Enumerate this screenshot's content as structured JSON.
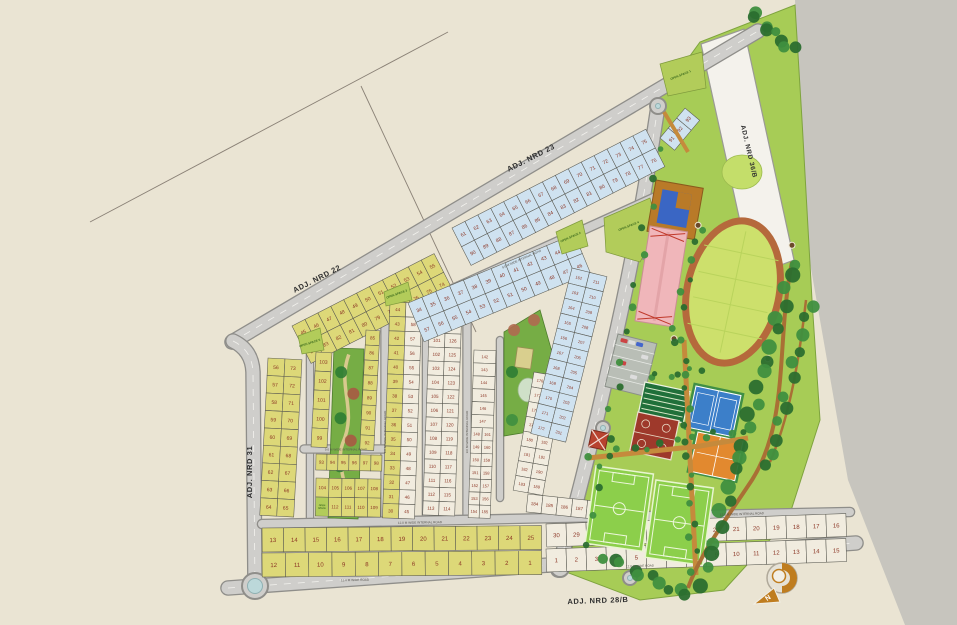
{
  "photo": {
    "width": 957,
    "height": 625,
    "bg": "#eae4d3",
    "bg_edge": "#c7c5be",
    "gray_region": "795,0 957,0 957,625 905,625 848,480 806,240",
    "boundary_lines": [
      [
        90,
        222,
        448,
        32
      ],
      [
        361,
        86,
        476,
        332
      ]
    ]
  },
  "colors": {
    "road_fill": "#cfcecb",
    "road_edge": "#8f8e8a",
    "road_dash": "#f3f2ee",
    "plot_yellow": "#ddd878",
    "plot_white": "#f1ecdf",
    "plot_blue": "#cfe2f0",
    "plot_stroke": "#5a5a52",
    "num_color": "#8b3524",
    "open_green": "#b2cc5a",
    "open_text": "#3d6b1f",
    "park_green": "#76ad45",
    "sport_green": "#a7cc56",
    "field_green": "#8ccf4b",
    "track_infield": "#cde06c",
    "track_ring": "#b5693c",
    "court_blue": "#3c7fc9",
    "court_orange": "#e2892f",
    "court_red": "#9e392b",
    "net_green": "#20703a",
    "path_brown": "#c58a3c",
    "path_dark": "#a96f35",
    "tree_dark": "#2b6e2f",
    "tree_mid": "#3f8f3f",
    "pool_blue": "#3a66c4",
    "deck_brown": "#b97a28",
    "bldg_pink": "#f0b6ba",
    "bldg_red": "#b8432f",
    "strip_white": "#f4f2ec",
    "parking_gray": "#b9beb6",
    "label_color": "#2f2f2f",
    "internal_label": "#55524c",
    "compass_orange": "#bf7d1f"
  },
  "roads": {
    "paths": [
      {
        "id": "adj-nrd-22-23",
        "d": "M 232,342 L 758,31",
        "w": 13
      },
      {
        "id": "adj-nrd-31",
        "d": "M 233,341 Q 252,350 253,372 L 255,589",
        "w": 13
      },
      {
        "id": "adj-nrd-28b",
        "d": "M 228,588 L 856,543",
        "w": 13
      },
      {
        "id": "spine-road",
        "d": "M 658,106 Q 638,240 612,352 Q 588,462 558,570",
        "w": 13
      },
      {
        "id": "internal-v1",
        "d": "M 385,296 L 385,520",
        "w": 7
      },
      {
        "id": "internal-v2",
        "d": "M 426,300 L 426,520",
        "w": 6
      },
      {
        "id": "internal-v3",
        "d": "M 467,312 L 467,520",
        "w": 7
      },
      {
        "id": "internal-v4",
        "d": "M 500,340 L 500,498",
        "w": 6
      },
      {
        "id": "internal-park-left",
        "d": "M 310,345 L 310,520",
        "w": 6
      },
      {
        "id": "internal-h1",
        "d": "M 304,449 L 388,449",
        "w": 7
      },
      {
        "id": "internal-h2",
        "d": "M 262,524 L 850,512",
        "w": 8
      },
      {
        "id": "internal-d1",
        "d": "M 402,312 L 658,196",
        "w": 8
      }
    ],
    "roundabouts": [
      {
        "x": 255,
        "y": 586,
        "r": 13
      },
      {
        "x": 645,
        "y": 252,
        "r": 7
      },
      {
        "x": 603,
        "y": 428,
        "r": 7
      },
      {
        "x": 560,
        "y": 568,
        "r": 9
      },
      {
        "x": 658,
        "y": 106,
        "r": 8
      },
      {
        "x": 630,
        "y": 578,
        "r": 7
      }
    ],
    "labels": [
      {
        "id": "adj-nrd-23",
        "text": "ADJ. NRD 23",
        "x": 532,
        "y": 160,
        "rot": -27,
        "fs": 7.5
      },
      {
        "id": "adj-nrd-22",
        "text": "ADJ. NRD 22",
        "x": 318,
        "y": 281,
        "rot": -27,
        "fs": 7.5
      },
      {
        "id": "adj-nrd-31",
        "text": "ADJ. NRD 31",
        "x": 252,
        "y": 472,
        "rot": -90,
        "fs": 7.5
      },
      {
        "id": "adj-nrd-28b",
        "text": "ADJ. NRD 28/B",
        "x": 598,
        "y": 603,
        "rot": -2,
        "fs": 7.5
      },
      {
        "id": "adj-nrd-36b",
        "text": "ADJ. NRD 36/B",
        "x": 747,
        "y": 152,
        "rot": 77,
        "fs": 6.5
      }
    ],
    "internal_labels": [
      {
        "text": "9.0 M WIDE INTERNAL ROAD",
        "x": 386,
        "y": 432,
        "rot": -90
      },
      {
        "text": "9.0 M WIDE INTERNAL ROAD",
        "x": 468,
        "y": 432,
        "rot": -90
      },
      {
        "text": "9.0 M WIDE INTERNAL ROAD",
        "x": 522,
        "y": 260,
        "rot": -24
      },
      {
        "text": "9.0 M WIDE INTERNAL ROAD",
        "x": 346,
        "y": 450.5,
        "rot": 0
      },
      {
        "text": "12.0 M WIDE INTERNAL ROAD",
        "x": 420,
        "y": 523.5,
        "rot": -1
      },
      {
        "text": "12.0 M WIDE INTERNAL ROAD",
        "x": 742,
        "y": 515,
        "rot": -2
      },
      {
        "text": "12.0 M WIDE ROAD",
        "x": 355,
        "y": 581,
        "rot": -1
      },
      {
        "text": "12.0 M WIDE ROAD",
        "x": 640,
        "y": 567,
        "rot": -2
      }
    ],
    "strip_36b": {
      "poly": "701,44 744,29 794,260 752,276"
    }
  },
  "open_spaces": [
    {
      "label": "OPEN SPACE 1",
      "x": 681,
      "y": 76,
      "rot": -22,
      "poly": "660,64 702,52 706,88 668,96"
    },
    {
      "label": "OPEN SPACE 2",
      "x": 571,
      "y": 238,
      "rot": -24,
      "poly": "556,232 582,220 588,246 562,254"
    },
    {
      "label": "OPEN SPACE 3",
      "x": 397,
      "y": 295,
      "rot": -20,
      "poly": "384,292 408,282 412,300 386,306"
    },
    {
      "label": "OPEN SPACE 4",
      "x": 629,
      "y": 227,
      "rot": -22,
      "poly": "604,218 650,198 658,230 640,262 606,252"
    },
    {
      "label": "OPEN SPACE 5",
      "x": 310,
      "y": 344,
      "rot": -18,
      "poly": "298,336 320,328 324,350 302,354"
    }
  ],
  "plot_blocks": [
    {
      "id": "yellow-strip-nrd22",
      "fill": "yellow",
      "x": 292,
      "y": 326,
      "rot": -27,
      "cw": 14.5,
      "ch": 21,
      "fs": 5,
      "rows": [
        [
          45,
          46,
          47,
          48,
          49,
          50,
          51,
          52,
          53,
          54,
          55
        ],
        [
          84,
          83,
          82,
          81,
          80,
          79,
          78,
          77,
          76,
          75,
          74
        ]
      ]
    },
    {
      "id": "yellow-pairs-west",
      "fill": "yellow",
      "x": 268,
      "y": 358,
      "rot": 3,
      "cw": 17,
      "ch": 17.5,
      "fs": 5,
      "rows": [
        [
          56,
          73
        ],
        [
          57,
          72
        ],
        [
          58,
          71
        ],
        [
          59,
          70
        ],
        [
          60,
          69
        ],
        [
          61,
          68
        ],
        [
          62,
          67
        ],
        [
          63,
          66
        ],
        [
          64,
          65
        ]
      ]
    },
    {
      "id": "yellow-park-left-column",
      "fill": "yellow",
      "x": 316,
      "y": 352,
      "rot": 3,
      "cw": 16,
      "ch": 19,
      "fs": 5,
      "rows": [
        [
          103
        ],
        [
          102
        ],
        [
          101
        ],
        [
          100
        ],
        [
          99
        ]
      ]
    },
    {
      "id": "yellow-park-right-column",
      "fill": "yellow",
      "x": 366,
      "y": 330,
      "rot": 3,
      "cw": 14,
      "ch": 15,
      "fs": 4.5,
      "rows": [
        [
          85
        ],
        [
          86
        ],
        [
          87
        ],
        [
          88
        ],
        [
          89
        ],
        [
          90
        ],
        [
          91
        ],
        [
          92
        ]
      ]
    },
    {
      "id": "yellow-row-below-park",
      "fill": "yellow",
      "x": 316,
      "y": 454,
      "rot": 1,
      "cw": 11,
      "ch": 16,
      "fs": 4.5,
      "rows": [
        [
          93,
          94,
          95,
          96,
          97,
          98
        ]
      ]
    },
    {
      "id": "yellow-small-block",
      "fill": "yellow",
      "x": 316,
      "y": 478,
      "rot": 1,
      "cw": 13,
      "ch": 19,
      "fs": 4.5,
      "rows": [
        [
          104,
          105,
          106,
          107,
          108
        ],
        [
          "OPEN SPACE",
          112,
          111,
          110,
          109
        ]
      ]
    },
    {
      "id": "mixed-column-1",
      "fills": [
        "yellow",
        "white"
      ],
      "x": 390,
      "y": 302,
      "rot": 2,
      "cw": 16,
      "ch": 14.4,
      "fs": 4.5,
      "rows": [
        [
          44,
          59
        ],
        [
          43,
          58
        ],
        [
          42,
          57
        ],
        [
          41,
          56
        ],
        [
          40,
          55
        ],
        [
          39,
          54
        ],
        [
          38,
          53
        ],
        [
          37,
          52
        ],
        [
          36,
          51
        ],
        [
          35,
          50
        ],
        [
          34,
          49
        ],
        [
          33,
          48
        ],
        [
          32,
          47
        ],
        [
          31,
          46
        ],
        [
          30,
          45
        ]
      ]
    },
    {
      "id": "white-column-2",
      "fill": "white",
      "x": 430,
      "y": 305,
      "rot": 2,
      "cw": 16,
      "ch": 14,
      "fs": 4.5,
      "rows": [
        [
          99,
          128
        ],
        [
          100,
          127
        ],
        [
          101,
          126
        ],
        [
          102,
          125
        ],
        [
          103,
          124
        ],
        [
          104,
          123
        ],
        [
          105,
          122
        ],
        [
          106,
          121
        ],
        [
          107,
          120
        ],
        [
          108,
          119
        ],
        [
          109,
          118
        ],
        [
          110,
          117
        ],
        [
          111,
          116
        ],
        [
          112,
          115
        ],
        [
          113,
          114
        ]
      ]
    },
    {
      "id": "white-column-3",
      "fill": "white",
      "x": 474,
      "y": 350,
      "rot": 2,
      "cw": 11,
      "ch": 12.9,
      "fs": 4,
      "singleSpan": 2,
      "rows": [
        [
          142
        ],
        [
          143
        ],
        [
          144
        ],
        [
          145
        ],
        [
          146
        ],
        [
          147
        ],
        [
          148,
          161
        ],
        [
          149,
          160
        ],
        [
          150,
          159
        ],
        [
          151,
          158
        ],
        [
          152,
          157
        ],
        [
          153,
          156
        ],
        [
          154,
          155
        ]
      ]
    },
    {
      "id": "white-block-south",
      "fill": "white",
      "x": 534,
      "y": 372,
      "rot": 10,
      "cw": 15,
      "ch": 15,
      "fs": 4,
      "rows": [
        [
          176,
          196
        ],
        [
          177,
          195
        ],
        [
          178,
          194
        ],
        [
          179,
          193
        ],
        [
          180,
          192
        ],
        [
          181,
          191
        ],
        [
          182,
          190
        ],
        [
          183,
          189
        ]
      ]
    },
    {
      "id": "white-block-south-row",
      "fill": "white",
      "x": 528,
      "y": 494,
      "rot": 6,
      "cw": 15,
      "ch": 18,
      "fs": 4.5,
      "rows": [
        [
          184,
          185,
          186,
          187,
          188
        ]
      ]
    },
    {
      "id": "blue-strip-nrd23",
      "fill": "blue",
      "x": 452,
      "y": 228,
      "rot": -27,
      "cw": 14.5,
      "ch": 21,
      "fs": 5,
      "rows": [
        [
          61,
          62,
          63,
          64,
          65,
          66,
          67,
          68,
          69,
          70,
          71,
          72,
          73,
          74,
          75
        ],
        [
          90,
          89,
          88,
          87,
          86,
          85,
          84,
          83,
          82,
          81,
          80,
          79,
          78,
          77,
          76
        ]
      ]
    },
    {
      "id": "blue-corner",
      "fill": "blue",
      "x": 660,
      "y": 138,
      "rot": -50,
      "cw": 13,
      "ch": 19,
      "fs": 5,
      "rows": [
        [
          91,
          92,
          93
        ]
      ]
    },
    {
      "id": "blue-band",
      "fill": "blue",
      "x": 408,
      "y": 303,
      "rot": -22.5,
      "cw": 15,
      "ch": 21,
      "fs": 5,
      "rows": [
        [
          34,
          35,
          36,
          37,
          38,
          39,
          40,
          41,
          42,
          43,
          44,
          45
        ],
        [
          57,
          56,
          55,
          54,
          53,
          52,
          51,
          50,
          49,
          48,
          47,
          46
        ]
      ]
    },
    {
      "id": "blue-pairs-east",
      "fill": "blue",
      "x": 572,
      "y": 268,
      "rot": 14,
      "cw": 18,
      "ch": 15.5,
      "fs": 4,
      "rows": [
        [
          162,
          211
        ],
        [
          163,
          210
        ],
        [
          164,
          209
        ],
        [
          165,
          208
        ],
        [
          166,
          207
        ],
        [
          167,
          206
        ],
        [
          168,
          205
        ],
        [
          169,
          204
        ],
        [
          170,
          203
        ],
        [
          171,
          202
        ],
        [
          172,
          201
        ]
      ]
    },
    {
      "id": "yellow-south-row-upper",
      "fill": "yellow",
      "x": 262,
      "y": 528,
      "rot": -0.5,
      "cw": 21.5,
      "ch": 24,
      "fs": 6,
      "rows": [
        [
          13,
          14,
          15,
          16,
          17,
          18,
          19,
          20,
          21,
          22,
          23,
          24,
          25
        ]
      ]
    },
    {
      "id": "yellow-south-row-lower",
      "fill": "yellow",
      "x": 262,
      "y": 553,
      "rot": -0.5,
      "cw": 23.3,
      "ch": 24,
      "fs": 6,
      "rows": [
        [
          12,
          11,
          10,
          9,
          8,
          7,
          6,
          5,
          4,
          3,
          2,
          1
        ]
      ]
    },
    {
      "id": "white-south-row-upper",
      "fill": "white",
      "x": 546,
      "y": 524,
      "rot": -2,
      "cw": 20,
      "ch": 23,
      "fs": 6,
      "rows": [
        [
          30,
          29,
          28,
          27,
          26,
          25,
          24,
          23,
          22,
          21,
          20,
          19,
          18,
          17,
          16
        ]
      ]
    },
    {
      "id": "white-south-row-lower",
      "fill": "white",
      "x": 546,
      "y": 549,
      "rot": -2,
      "cw": 20,
      "ch": 23,
      "fs": 6,
      "rows": [
        [
          1,
          2,
          3,
          4,
          5,
          6,
          7,
          8,
          9,
          10,
          11,
          12,
          13,
          14,
          15
        ]
      ]
    }
  ],
  "sports_complex": {
    "base_poly": "658,100 700,42 795,5 802,120 812,300 820,420 788,520 724,590 640,600 566,572 594,462 618,352 640,240 652,180",
    "facilities": [
      "parking-lot",
      "swimming-pool",
      "club-building",
      "stadium-oval",
      "practice-nets-court",
      "basketball-court",
      "tennis-court",
      "volleyball-court",
      "football-field",
      "football-field",
      "gazebo"
    ]
  },
  "compass": {
    "label": "N"
  }
}
